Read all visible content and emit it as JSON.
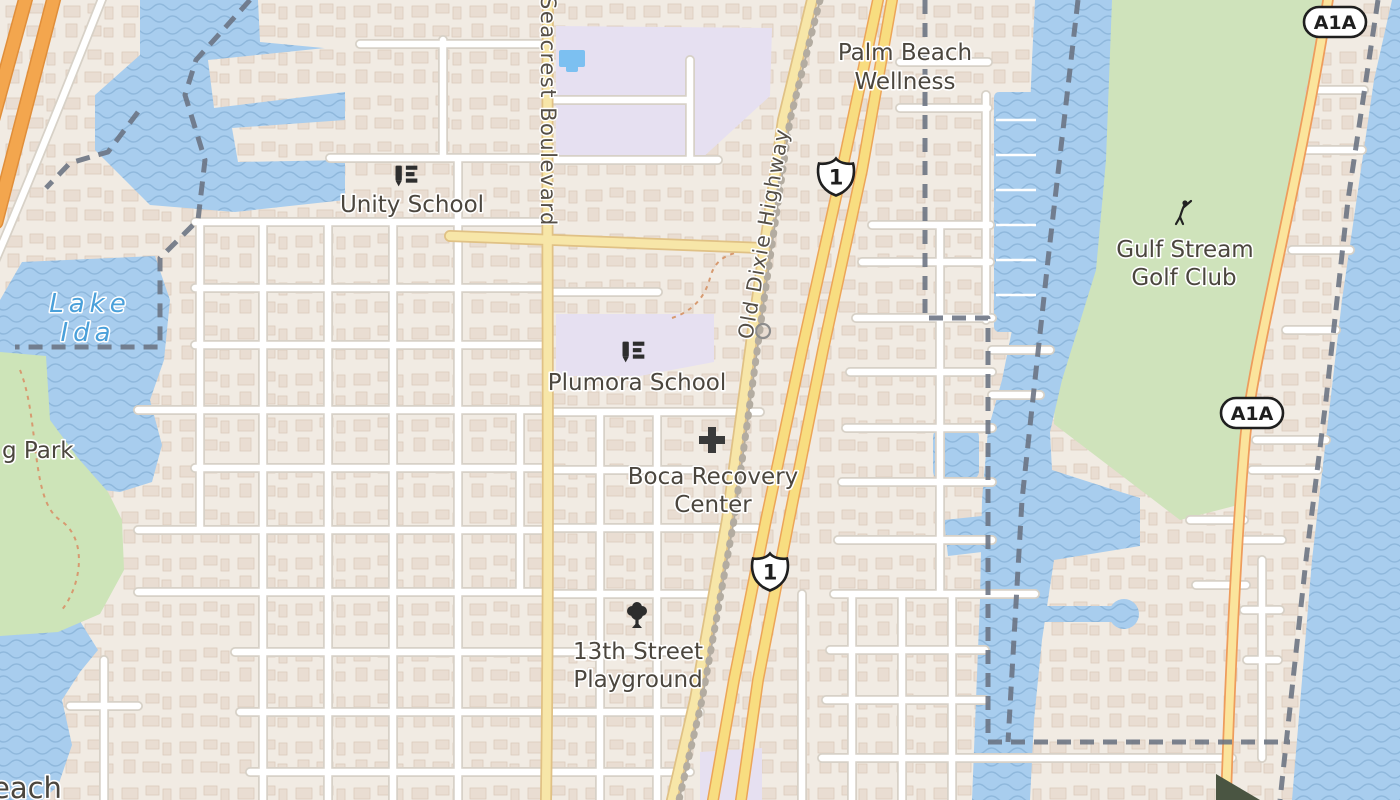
{
  "map": {
    "labels": {
      "unity": "Unity School",
      "plumora": "Plumora School",
      "palm1": "Palm Beach",
      "palm2": "Wellness",
      "boca1": "Boca Recovery",
      "boca2": "Center",
      "play1": "13th Street",
      "play2": "Playground",
      "golf1": "Gulf Stream",
      "golf2": "Golf Club",
      "lake1": "Lake",
      "lake2": "Ida",
      "park_partial": "g Park",
      "beach_partial": "each"
    },
    "roads": {
      "seacrest": "Seacrest Boulevard",
      "old_dixie": "Old Dixie Highway"
    },
    "shields": {
      "us1": "1",
      "a1a": "A1A"
    },
    "icons": [
      "school-icon",
      "hospital-cross-icon",
      "tree-icon",
      "golfer-icon"
    ],
    "colors": {
      "land": "#f1ebe3",
      "water": "#a8cdee",
      "wave": "#8fb8dc",
      "green_park": "#cde4b8",
      "green_golf": "#cfe3bb",
      "school_zone": "#e6e0f1",
      "pool": "#7cc0f1",
      "road_yellow": "#f7e6a8",
      "road_highway": "#f8dd80",
      "road_motorway": "#f3a64e",
      "boundary": "#6a7382",
      "label_dark": "#4b463e",
      "label_water": "#4aa0da",
      "label_road": "#554f47"
    }
  }
}
